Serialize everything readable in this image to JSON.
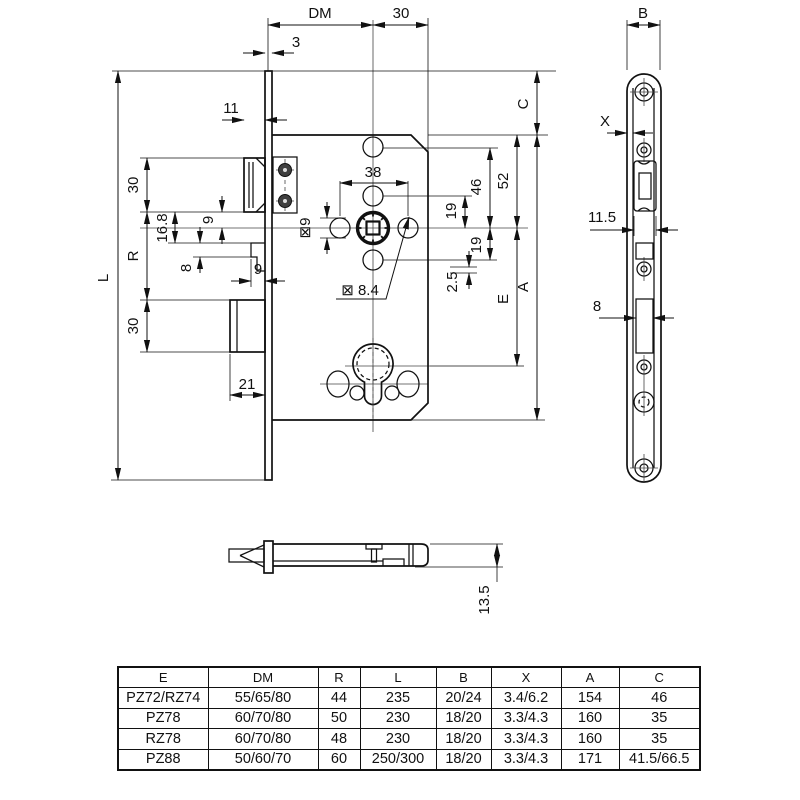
{
  "drawing": {
    "main": {
      "dm": "DM",
      "top30": "30",
      "t3": "3",
      "t11": "11",
      "left30a": "30",
      "r9": "9",
      "d168": "16.8",
      "d8": "8",
      "h9": "9",
      "r": "R",
      "l": "L",
      "left30b": "30",
      "d21": "21",
      "d38": "38",
      "sq9": "⊠9",
      "sq84": "⊠ 8.4",
      "d19a": "19",
      "d19b": "19",
      "d46": "46",
      "d52": "52",
      "d25": "2.5",
      "e": "E",
      "a": "A",
      "c": "C"
    },
    "side": {
      "b": "B",
      "x": "X",
      "d115": "11.5",
      "d8": "8"
    },
    "bottom": {
      "d135": "13.5"
    }
  },
  "table": {
    "headers": [
      "E",
      "DM",
      "R",
      "L",
      "B",
      "X",
      "A",
      "C"
    ],
    "rows": [
      [
        "PZ72/RZ74",
        "55/65/80",
        "44",
        "235",
        "20/24",
        "3.4/6.2",
        "154",
        "46"
      ],
      [
        "PZ78",
        "60/70/80",
        "50",
        "230",
        "18/20",
        "3.3/4.3",
        "160",
        "35"
      ],
      [
        "RZ78",
        "60/70/80",
        "48",
        "230",
        "18/20",
        "3.3/4.3",
        "160",
        "35"
      ],
      [
        "PZ88",
        "50/60/70",
        "60",
        "250/300",
        "18/20",
        "3.3/4.3",
        "171",
        "41.5/66.5"
      ]
    ]
  }
}
